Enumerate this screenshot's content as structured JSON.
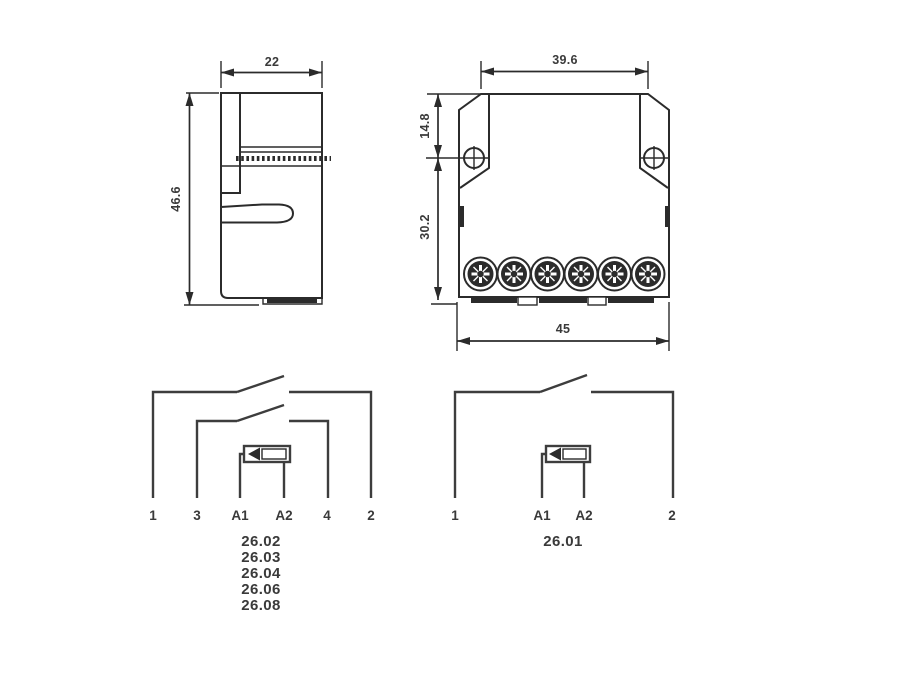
{
  "drawing": {
    "title": "relay-dimension-and-wiring-diagram",
    "colors": {
      "line": "#2b2b2b",
      "text": "#3a3a3a",
      "background": "#ffffff"
    },
    "side_view": {
      "width_dim": "22",
      "height_dim": "46.6"
    },
    "front_view": {
      "top_width_dim": "39.6",
      "upper_height_dim": "14.8",
      "lower_height_dim": "30.2",
      "bottom_width_dim": "45"
    },
    "schematic_multi": {
      "terminals": [
        "1",
        "3",
        "A1",
        "A2",
        "4",
        "2"
      ],
      "types": [
        "26.02",
        "26.03",
        "26.04",
        "26.06",
        "26.08"
      ]
    },
    "schematic_single": {
      "terminals": [
        "1",
        "A1",
        "A2",
        "2"
      ],
      "types": [
        "26.01"
      ]
    }
  }
}
